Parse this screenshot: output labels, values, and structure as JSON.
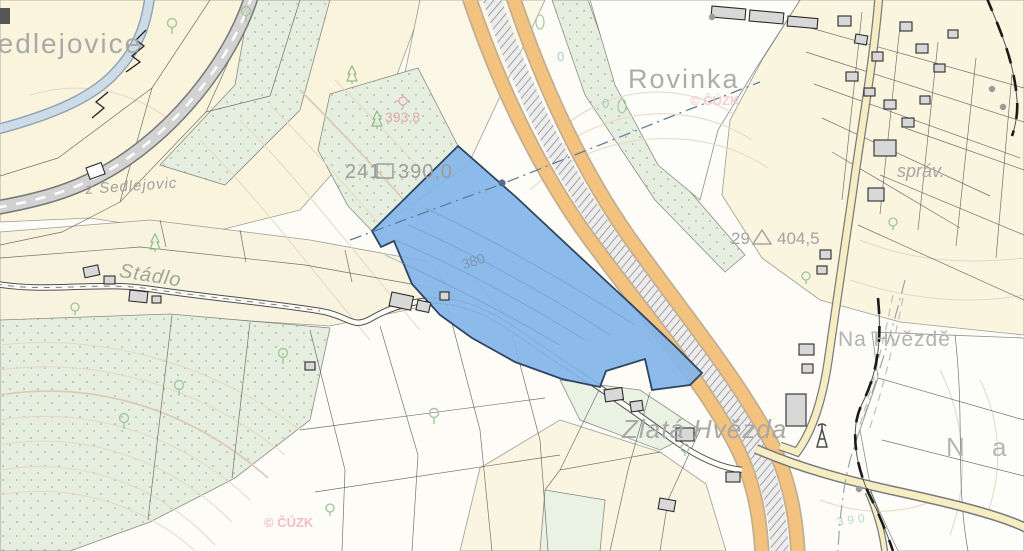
{
  "map": {
    "colors": {
      "background": "#FDFCF6",
      "field_yellow": "#FAF4DC",
      "vegetation_green": "#E6EFDF",
      "highway_orange": "#F2C27E",
      "road_yellow": "#F6EEC2",
      "river_blue": "#CDDBE6",
      "railway_grey": "#D2D2D2",
      "selected_parcel_fill": "#82B5E9",
      "selected_parcel_border": "#2E4560",
      "label_grey": "#A8A8A8",
      "watermark_pink": "#F3BCC4",
      "contour_tan": "#E7D6C7",
      "cadastre_boundary": "#1A1A1A"
    },
    "labels": [
      {
        "name": "place-label-sedlejovice",
        "text": "Sedlejovice",
        "x": -23,
        "y": 30,
        "size": 28,
        "color": "#A9A9A9",
        "spacing": 2
      },
      {
        "name": "road-label-z-sedlejovic",
        "text": "z Sedlejovic",
        "x": 85,
        "y": 182,
        "size": 15,
        "color": "#9F9F9F",
        "italic": true,
        "rotate": -4,
        "spacing": 1
      },
      {
        "name": "place-label-stadlo",
        "text": "Stádlo",
        "x": 121,
        "y": 261,
        "size": 20,
        "color": "#9CA795",
        "italic": true,
        "rotate": 9,
        "spacing": 1
      },
      {
        "name": "place-label-rovinka",
        "text": "Rovinka",
        "x": 628,
        "y": 66,
        "size": 27,
        "color": "#ACACAC",
        "spacing": 2
      },
      {
        "name": "parcel-number-241",
        "text": "241",
        "x": 345,
        "y": 162,
        "size": 20,
        "color": "#9C9C9C",
        "spacing": 1
      },
      {
        "name": "parcel-area-390",
        "text": "390,0",
        "x": 398,
        "y": 162,
        "size": 20,
        "color": "#9C9C9C",
        "spacing": 1
      },
      {
        "name": "spot-height-393",
        "text": "393,8",
        "x": 385,
        "y": 110,
        "size": 14,
        "color": "#DBA4A4",
        "opacity": 0.9
      },
      {
        "name": "parcel-number-29",
        "text": "29",
        "x": 731,
        "y": 230,
        "size": 17,
        "color": "#A2A2A2"
      },
      {
        "name": "parcel-area-404",
        "text": "404,5",
        "x": 777,
        "y": 230,
        "size": 17,
        "color": "#A2A2A2"
      },
      {
        "name": "place-label-sprav",
        "text": "správ.",
        "x": 897,
        "y": 162,
        "size": 18,
        "color": "#A6A6A6",
        "italic": true
      },
      {
        "name": "place-label-na-hvezde",
        "text": "Na Hvězdě",
        "x": 838,
        "y": 329,
        "size": 21,
        "color": "#B2B2B2",
        "spacing": 1
      },
      {
        "name": "place-label-zlata-hvezda",
        "text": "Zlatá Hvězda",
        "x": 622,
        "y": 416,
        "size": 26,
        "color": "#A8A8A8",
        "italic": true,
        "spacing": 1
      },
      {
        "name": "place-label-na-fragment",
        "text": "N a",
        "x": 946,
        "y": 434,
        "size": 26,
        "color": "#B5B5B5",
        "spacing": 10
      },
      {
        "name": "contour-label-380",
        "text": "380",
        "x": 460,
        "y": 258,
        "size": 14,
        "color": "#7E93A6",
        "rotate": -18,
        "opacity": 0.9
      },
      {
        "name": "contour-label-0-a",
        "text": "0",
        "x": 557,
        "y": 50,
        "size": 13,
        "color": "#8FC4BC",
        "opacity": 0.8
      },
      {
        "name": "contour-label-0-b",
        "text": "0",
        "x": 602,
        "y": 97,
        "size": 13,
        "color": "#8FC4BC",
        "opacity": 0.8
      },
      {
        "name": "contour-label-390",
        "text": "390",
        "x": 836,
        "y": 516,
        "size": 12,
        "color": "#9BCAC4",
        "opacity": 0.7,
        "spacing": 4,
        "rotate": -8
      },
      {
        "name": "watermark-cuzk-top",
        "text": "© ČÚZK",
        "x": 690,
        "y": 94,
        "size": 13,
        "color": "#F3BCC4",
        "bold": true,
        "opacity": 0.7
      },
      {
        "name": "watermark-cuzk-bottom",
        "text": "© ČÚZK",
        "x": 264,
        "y": 516,
        "size": 13,
        "color": "#F0B4BE",
        "bold": true,
        "opacity": 0.85
      }
    ],
    "symbols": [
      {
        "type": "deciduous-tree",
        "x": 172,
        "y": 26
      },
      {
        "type": "deciduous-tree",
        "x": 246,
        "y": 14
      },
      {
        "type": "deciduous-tree",
        "x": 283,
        "y": 356
      },
      {
        "type": "deciduous-tree",
        "x": 179,
        "y": 388
      },
      {
        "type": "deciduous-tree",
        "x": 124,
        "y": 421
      },
      {
        "type": "deciduous-tree",
        "x": 434,
        "y": 416
      },
      {
        "type": "tree-ellipse",
        "x": 540,
        "y": 22
      },
      {
        "type": "tree-ellipse",
        "x": 622,
        "y": 106
      },
      {
        "type": "conifer-tree",
        "x": 352,
        "y": 75
      },
      {
        "type": "conifer-tree",
        "x": 377,
        "y": 120
      },
      {
        "type": "conifer-tree",
        "x": 155,
        "y": 243
      },
      {
        "type": "tree-circle",
        "x": 893,
        "y": 222
      },
      {
        "type": "tree-circle",
        "x": 806,
        "y": 276
      },
      {
        "type": "tree-circle",
        "x": 685,
        "y": 448
      },
      {
        "type": "tree-circle",
        "x": 75,
        "y": 307
      },
      {
        "type": "tree-circle",
        "x": 330,
        "y": 508
      },
      {
        "type": "spot-height",
        "x": 403,
        "y": 101
      },
      {
        "type": "antenna",
        "x": 822,
        "y": 437
      },
      {
        "type": "survey-dot",
        "x": 992,
        "y": 89
      },
      {
        "type": "survey-dot",
        "x": 1003,
        "y": 107
      },
      {
        "type": "survey-dot",
        "x": 859,
        "y": 489
      },
      {
        "type": "survey-dot",
        "x": 712,
        "y": 17
      },
      {
        "type": "utility-dot",
        "x": 502,
        "y": 183
      },
      {
        "type": "square-sym",
        "x": 385,
        "y": 171
      },
      {
        "type": "triangle-sym",
        "x": 762,
        "y": 238
      }
    ]
  }
}
